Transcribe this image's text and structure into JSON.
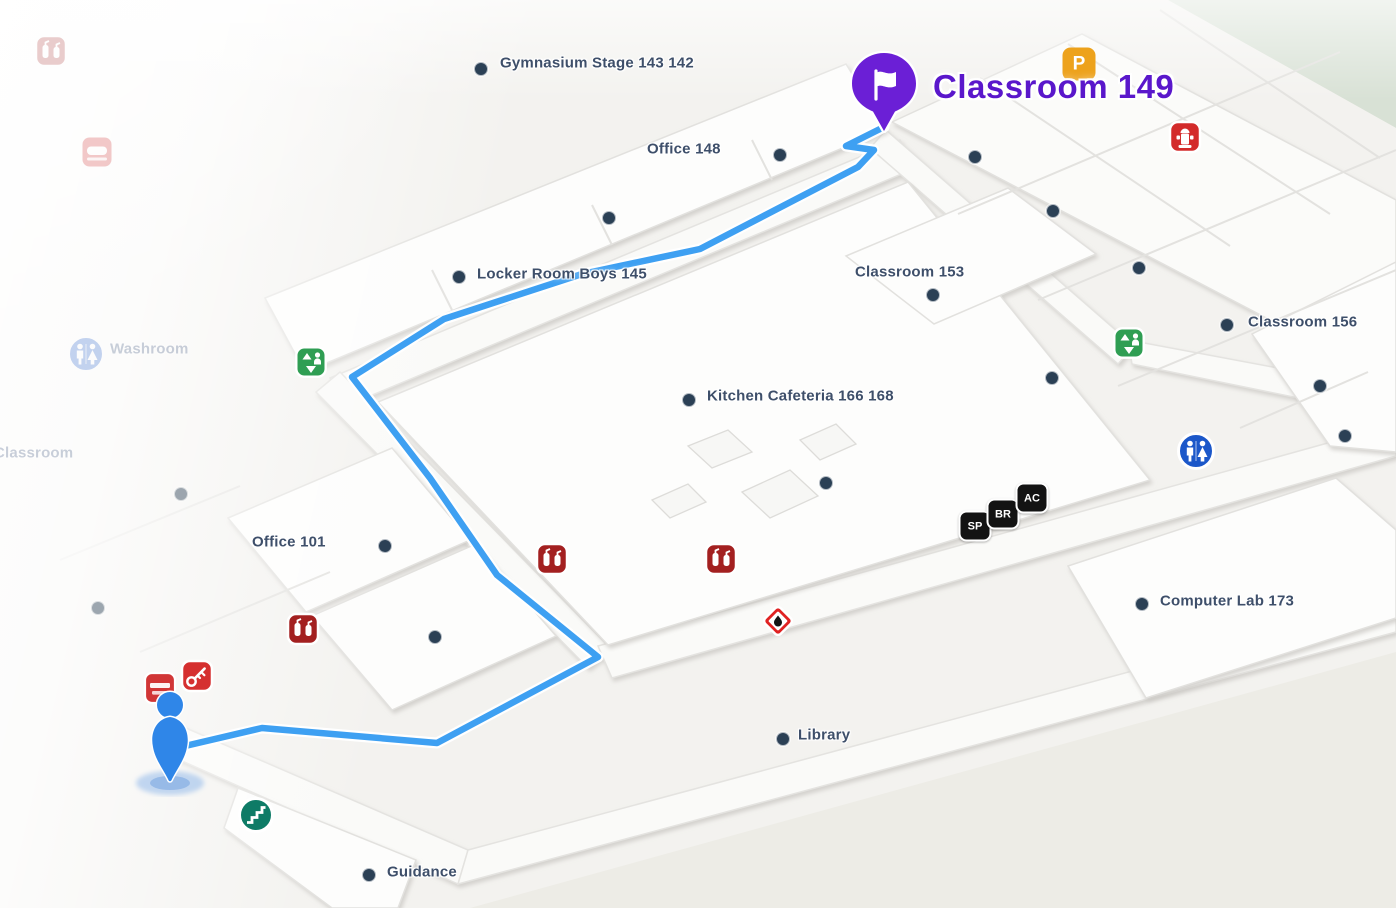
{
  "map": {
    "destination": {
      "label": "Classroom 149"
    },
    "route_color": "#3ea0f2",
    "labels": [
      {
        "text": "Gymnasium Stage 143 142",
        "x": 500,
        "y": 63
      },
      {
        "text": "Office 148",
        "x": 647,
        "y": 149
      },
      {
        "text": "Locker Room Boys 145",
        "x": 477,
        "y": 274
      },
      {
        "text": "Classroom 153",
        "x": 855,
        "y": 272
      },
      {
        "text": "Classroom 156",
        "x": 1248,
        "y": 322
      },
      {
        "text": "Kitchen Cafeteria 166 168",
        "x": 707,
        "y": 396
      },
      {
        "text": "Office 101",
        "x": 252,
        "y": 542
      },
      {
        "text": "Computer Lab 173",
        "x": 1160,
        "y": 601
      },
      {
        "text": "Library",
        "x": 798,
        "y": 735
      },
      {
        "text": "Guidance",
        "x": 387,
        "y": 872
      },
      {
        "text": "Washroom",
        "x": 110,
        "y": 349,
        "faded": true
      },
      {
        "text": "Classroom",
        "x": -6,
        "y": 453,
        "faded": true
      }
    ],
    "dots": [
      [
        481,
        69
      ],
      [
        780,
        155
      ],
      [
        609,
        218
      ],
      [
        975,
        157
      ],
      [
        1053,
        211
      ],
      [
        1139,
        268
      ],
      [
        459,
        277
      ],
      [
        933,
        295
      ],
      [
        1227,
        325
      ],
      [
        1320,
        386
      ],
      [
        1345,
        436
      ],
      [
        1052,
        378
      ],
      [
        689,
        400
      ],
      [
        826,
        483
      ],
      [
        385,
        546
      ],
      [
        435,
        637
      ],
      [
        1142,
        604
      ],
      [
        783,
        739
      ],
      [
        369,
        875
      ]
    ],
    "faded_dots": [
      [
        181,
        494
      ],
      [
        98,
        608
      ]
    ],
    "icons": [
      {
        "type": "fire-cabinet",
        "x": 51,
        "y": 51,
        "opacity": 0.22
      },
      {
        "type": "sign2",
        "x": 97,
        "y": 152,
        "opacity": 0.3
      },
      {
        "type": "washroom",
        "x": 86,
        "y": 354,
        "opacity": 0.25
      },
      {
        "type": "elevator",
        "x": 311,
        "y": 362
      },
      {
        "type": "elevator",
        "x": 1129,
        "y": 343
      },
      {
        "type": "p-badge",
        "x": 1079,
        "y": 64,
        "text": "P"
      },
      {
        "type": "hydrant",
        "x": 1185,
        "y": 137
      },
      {
        "type": "washroom",
        "x": 1196,
        "y": 451
      },
      {
        "type": "badge",
        "x": 975,
        "y": 526,
        "text": "SP"
      },
      {
        "type": "badge",
        "x": 1003,
        "y": 514,
        "text": "BR"
      },
      {
        "type": "badge",
        "x": 1032,
        "y": 498,
        "text": "AC"
      },
      {
        "type": "fire-cabinet",
        "x": 303,
        "y": 629
      },
      {
        "type": "fire-cabinet",
        "x": 552,
        "y": 559
      },
      {
        "type": "fire-cabinet",
        "x": 721,
        "y": 559
      },
      {
        "type": "hazard",
        "x": 778,
        "y": 621
      },
      {
        "type": "key",
        "x": 197,
        "y": 676
      },
      {
        "type": "sign",
        "x": 160,
        "y": 688
      },
      {
        "type": "stairs",
        "x": 256,
        "y": 815
      }
    ],
    "route": [
      [
        168,
        750
      ],
      [
        262,
        728
      ],
      [
        437,
        743
      ],
      [
        598,
        657
      ],
      [
        497,
        575
      ],
      [
        430,
        478
      ],
      [
        352,
        377
      ],
      [
        444,
        319
      ],
      [
        582,
        274
      ],
      [
        700,
        249
      ],
      [
        858,
        167
      ],
      [
        874,
        150
      ],
      [
        846,
        146
      ],
      [
        884,
        127
      ]
    ],
    "person": {
      "x": 170,
      "y": 739
    },
    "pin": {
      "x": 884,
      "y": 130
    }
  }
}
